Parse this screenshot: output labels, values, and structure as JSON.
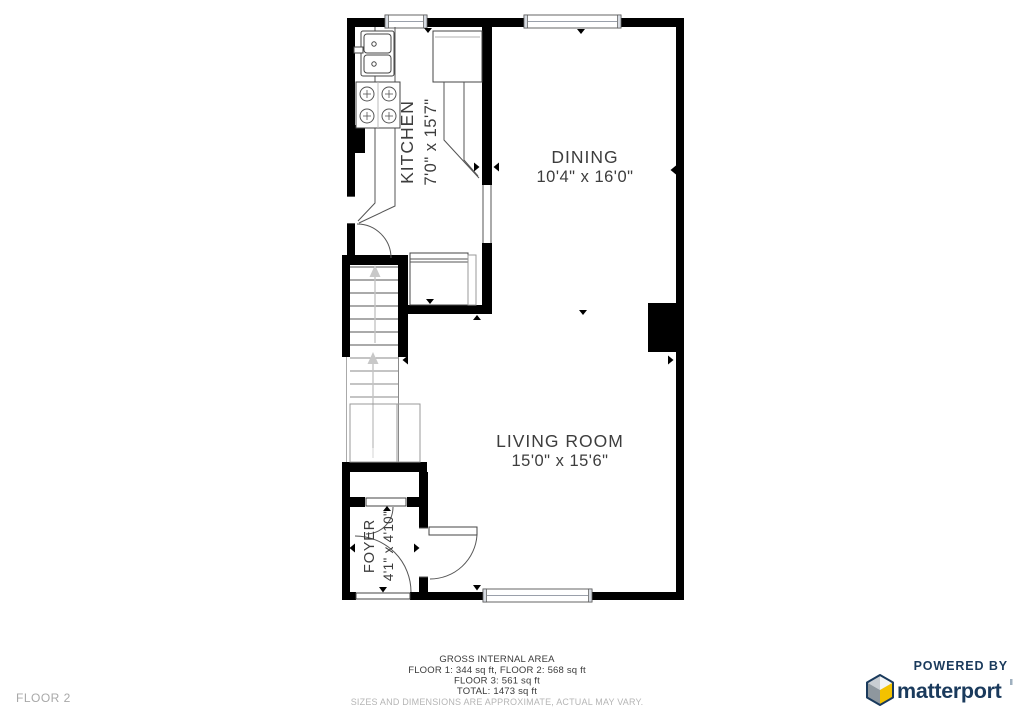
{
  "floor_plan": {
    "floor_label": "FLOOR 2",
    "wall_color": "#000000",
    "rooms": [
      {
        "name": "KITCHEN",
        "dims": "7'0\" x 15'7\""
      },
      {
        "name": "DINING",
        "dims": "10'4\" x 16'0\""
      },
      {
        "name": "LIVING ROOM",
        "dims": "15'0\" x 15'6\""
      },
      {
        "name": "FOYER",
        "dims": "4'1\" x 4'10\""
      }
    ],
    "fixtures": [
      "sink",
      "stove",
      "fridge",
      "counter",
      "stairs",
      "closet",
      "fireplace"
    ],
    "windows": 3,
    "doors": 4
  },
  "footer": {
    "title": "GROSS INTERNAL AREA",
    "line1": "FLOOR 1: 344 sq ft, FLOOR 2: 568 sq ft",
    "line2": "FLOOR 3: 561 sq ft",
    "line3": "TOTAL: 1473 sq ft",
    "disclaimer": "SIZES AND DIMENSIONS ARE APPROXIMATE, ACTUAL MAY VARY."
  },
  "branding": {
    "powered_by": "POWERED BY",
    "name": "matterport",
    "brand_color": "#1a3a5c",
    "cube_yellow": "#f3c200",
    "cube_gray": "#8e979e"
  }
}
